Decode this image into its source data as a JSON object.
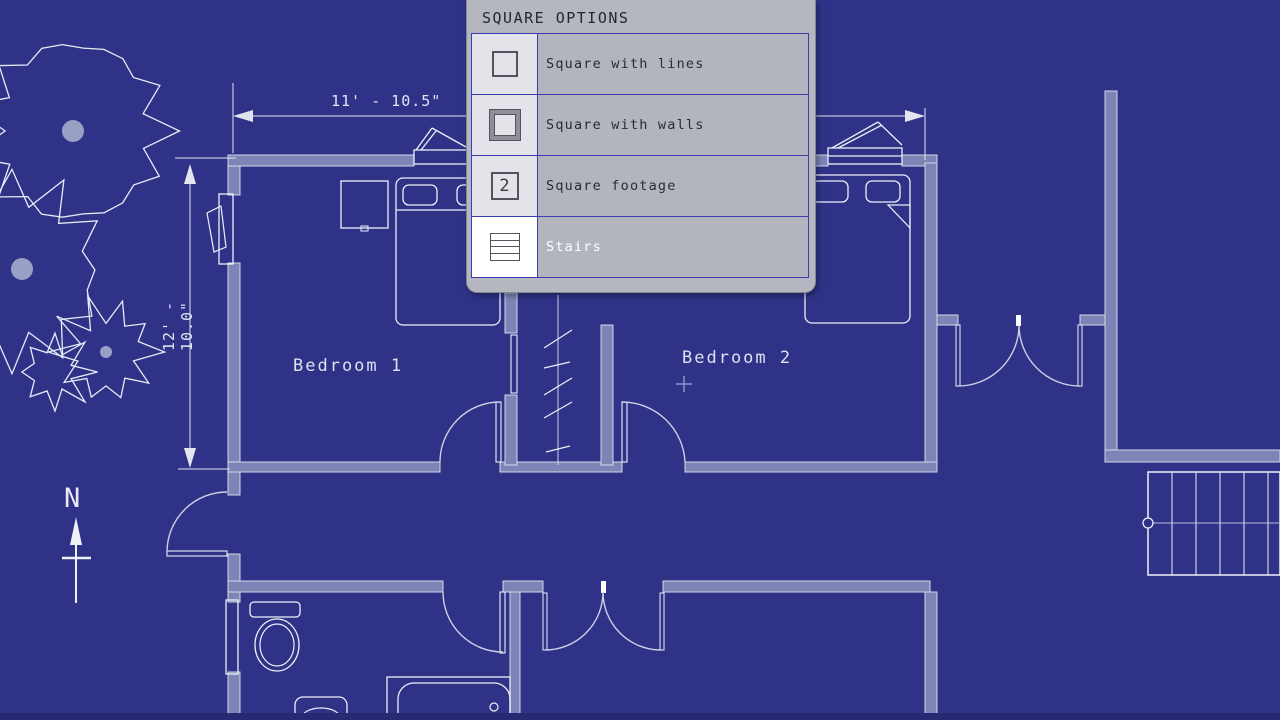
{
  "menu": {
    "title": "SQUARE OPTIONS",
    "items": [
      {
        "label": "Square with lines",
        "icon": "square-with-lines-icon",
        "highlighted": false
      },
      {
        "label": "Square with walls",
        "icon": "square-with-walls-icon",
        "highlighted": false
      },
      {
        "label": "Square footage",
        "icon": "square-footage-icon",
        "icon_text": "2",
        "highlighted": false
      },
      {
        "label": "Stairs",
        "icon": "stairs-icon",
        "highlighted": true
      }
    ]
  },
  "plan": {
    "rooms": [
      {
        "name": "Bedroom 1"
      },
      {
        "name": "Bedroom 2"
      }
    ],
    "dimensions": [
      {
        "label": "11' - 10.5\"",
        "orientation": "horizontal"
      },
      {
        "label": "12' - 10.0\"",
        "orientation": "vertical"
      }
    ],
    "compass": {
      "label": "N"
    },
    "colors": {
      "background": "#2f3287",
      "wall_fill": "#7e85b6",
      "wall_edge": "#d3d6e6",
      "line": "#eef0f8",
      "door": "#ccd1e5",
      "dim": "#e2e5f1",
      "tree": "#e8ebf5",
      "trunk": "#99a0c6",
      "cursor": "#8a92cc",
      "menu_border_blue": "#3b3bb2",
      "menu_panel": "#b4b7bf"
    }
  }
}
